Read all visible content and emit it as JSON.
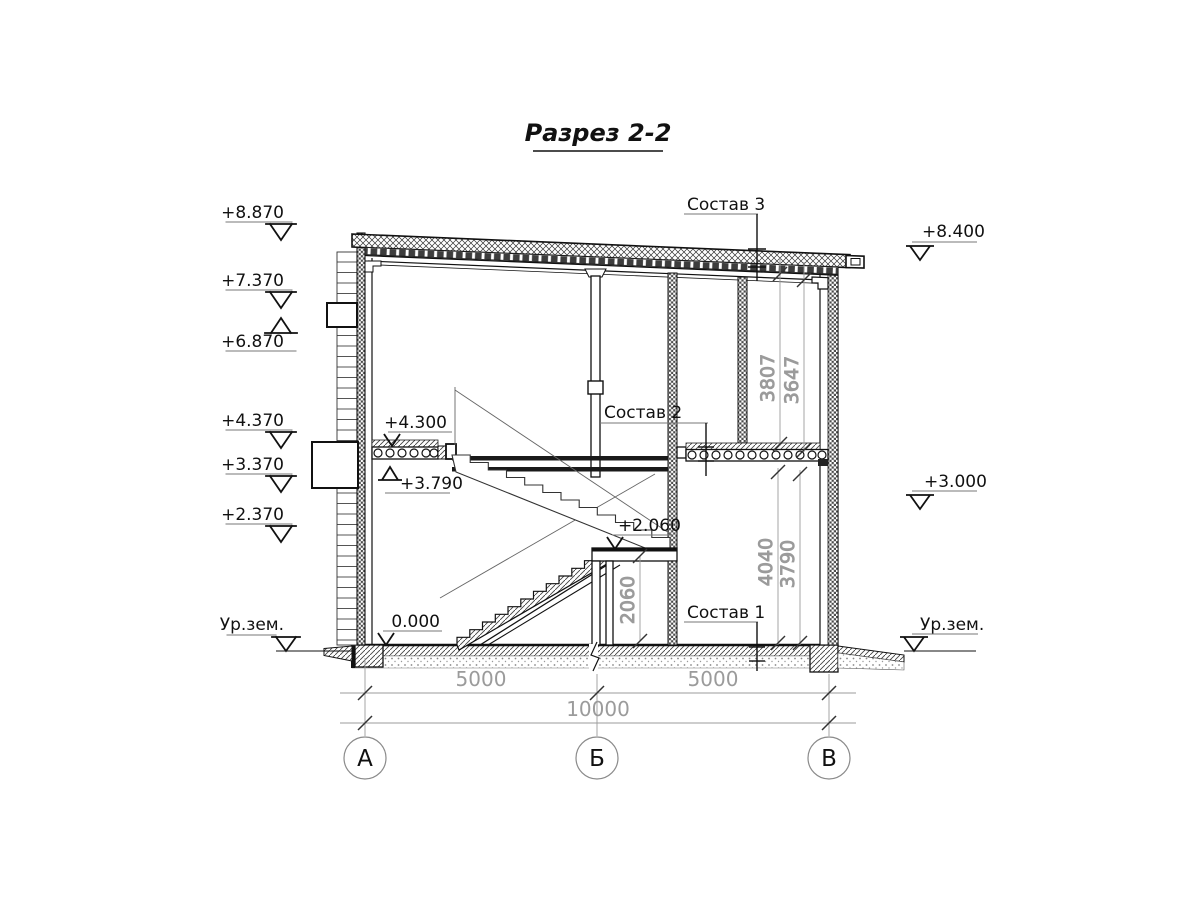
{
  "title": "Разрез 2-2",
  "colors": {
    "line": "#1a1a1a",
    "dim_gray": "#9b9b9b",
    "background": "#ffffff"
  },
  "left_marks": [
    "+8.870",
    "+7.370",
    "+6.870",
    "+4.370",
    "+3.370",
    "+2.370"
  ],
  "right_marks": [
    "+8.400",
    "+3.000"
  ],
  "ground_labels": [
    "Ур.зем.",
    "Ур.зем."
  ],
  "interior_marks": [
    "+4.300",
    "+3.790",
    "+2.060",
    "0.000"
  ],
  "callouts": [
    "Состав 3",
    "Состав 2",
    "Состав 1"
  ],
  "axis_labels": [
    "А",
    "Б",
    "В"
  ],
  "horizontal_dims": [
    "5000",
    "5000",
    "10000"
  ],
  "vertical_dims_upper": [
    "3807",
    "3647"
  ],
  "vertical_dims_lower": [
    "4040",
    "3790"
  ],
  "stair_dim": "2060"
}
